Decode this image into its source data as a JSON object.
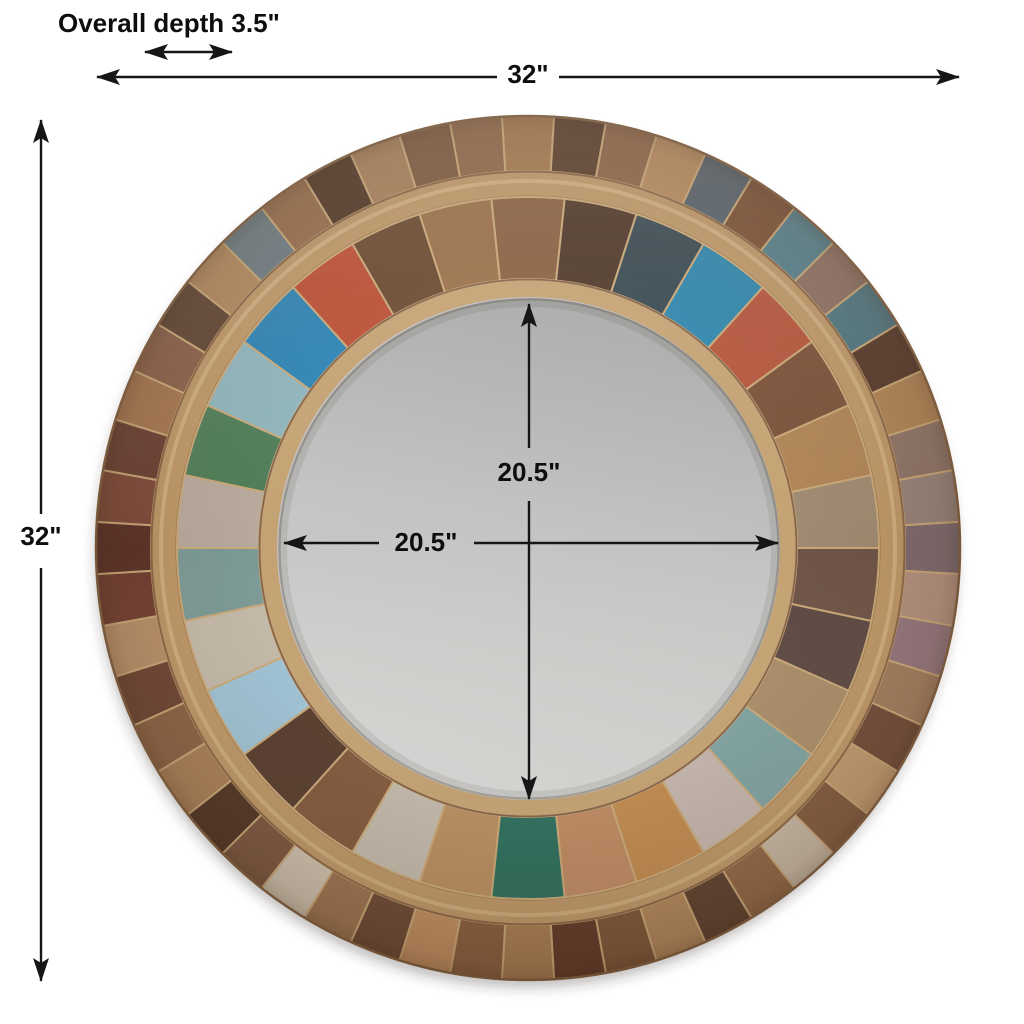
{
  "figure": {
    "type": "product-dimension-diagram",
    "subject": "round reclaimed wood patchwork mirror",
    "background_color": "#ffffff",
    "line_color": "#161616",
    "text_color": "#0e0e0e"
  },
  "annotations": {
    "depth": "Overall depth 3.5\"",
    "overall_width": "32\"",
    "overall_height": "32\"",
    "mirror_width": "20.5\"",
    "mirror_height": "20.5\""
  },
  "mirror": {
    "seam_color": "#c9a878",
    "edge_color": "#8a6747",
    "divider_color": "#bd9768",
    "divider_highlight": "#dcbf92",
    "inner_rim_color": "#c4a273",
    "glass": {
      "top": "#a8a8a6",
      "mid": "#c3c3c1",
      "bottom": "#d8d8d6"
    },
    "outer_blocks": [
      "#a5784e",
      "#5a3e2c",
      "#8c6547",
      "#b58a5d",
      "#56626b",
      "#7b5136",
      "#55808c",
      "#8d7064",
      "#4e7682",
      "#55392a",
      "#b08355",
      "#8d7468",
      "#97837b",
      "#7e6b70",
      "#b39181",
      "#93767e",
      "#a17d5e",
      "#6f4b38",
      "#c29a6e",
      "#815a3e",
      "#c7b8a6",
      "#926747",
      "#5e4130",
      "#b1875c",
      "#7d563b",
      "#62392a",
      "#a97e54",
      "#8a5f41",
      "#c08e62",
      "#6b4936",
      "#9c7351",
      "#cec2b0",
      "#7a5640",
      "#4e3424",
      "#aa8058",
      "#8c6245",
      "#6d4433",
      "#b9906a",
      "#713f33",
      "#5c332a",
      "#7e4b3c",
      "#6a4134",
      "#a5764f",
      "#8a604a",
      "#5f4534",
      "#b2885e",
      "#6c7b82",
      "#966c4b",
      "#503726",
      "#a8805a",
      "#7d5a40",
      "#8f6849"
    ],
    "inner_blocks": [
      "#8a6142",
      "#50392b",
      "#3a4a52",
      "#2f86ab",
      "#b5563d",
      "#7c523a",
      "#b08457",
      "#9f8a72",
      "#6f5547",
      "#5d4a43",
      "#a98d69",
      "#7fa2a0",
      "#c3b4ac",
      "#c08a4f",
      "#bd8a62",
      "#2e6e5d",
      "#b98e61",
      "#c2b9ab",
      "#82593d",
      "#573d2e",
      "#9ec2d4",
      "#c4b9a8",
      "#7d9a96",
      "#b7a99c",
      "#4f7d57",
      "#8fb4bb",
      "#2d83b4",
      "#bb4f35",
      "#6b4a31",
      "#9a7049"
    ]
  }
}
